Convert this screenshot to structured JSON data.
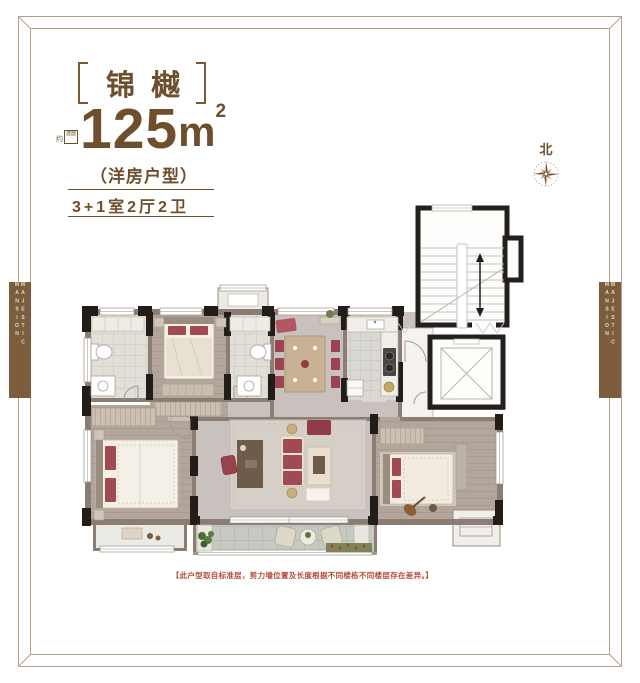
{
  "header": {
    "project_name": "锦樾",
    "area_prefix": "约",
    "area_badge": "建面",
    "area_value": "125",
    "area_unit": "m",
    "area_exponent": "2",
    "product_type": "（洋房户型）",
    "layout_spec": "3+1室2厅2卫"
  },
  "compass": {
    "north_label": "北"
  },
  "side_banners": {
    "left_text": "MAJESTIC MANSION",
    "right_text": "MAJESTIC MANSION"
  },
  "floor_plan": {
    "disclaimer": "【此户型取自标准层，剪力墙位置及长度根据不同楼栋不同楼层存在差异。】"
  },
  "colors": {
    "brand_brown": "#6d4f2e",
    "frame_line": "#b7a08a",
    "banner_bg": "#7c5e3f",
    "banner_text": "#ead9c4",
    "disclaimer_red": "#b5493b",
    "wall_black": "#221d19",
    "wall_taupe": "#8b7d72",
    "accent_maroon": "#9c4350"
  }
}
